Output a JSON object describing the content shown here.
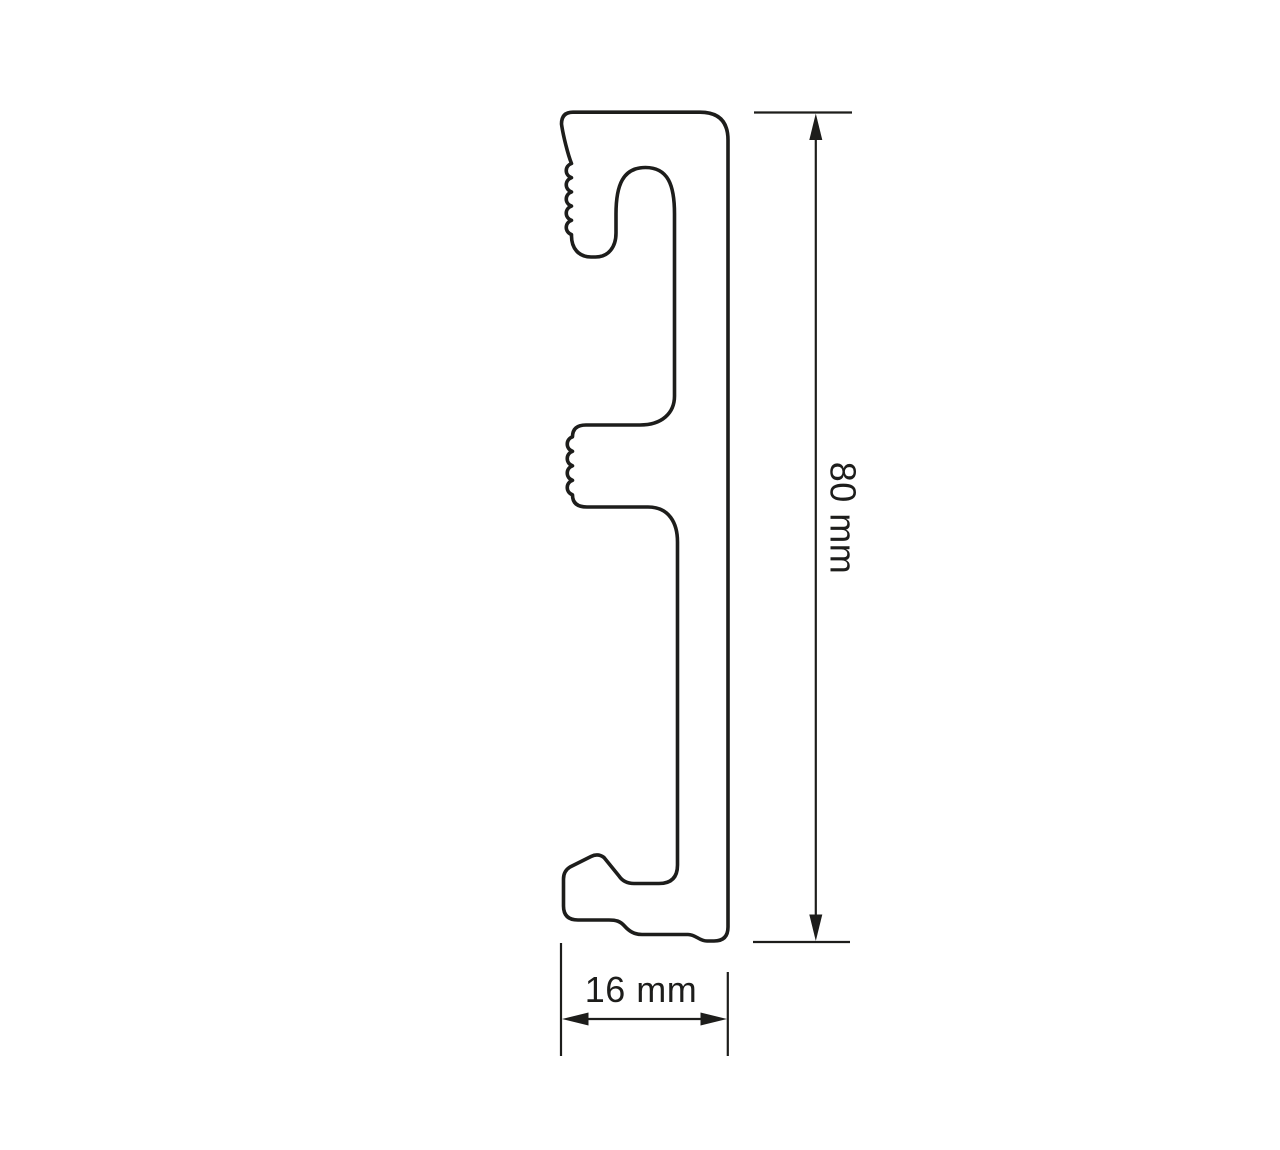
{
  "page": {
    "background_color": "#ffffff",
    "line_color": "#1d1d1b"
  },
  "drawing": {
    "subject": "skirting-board-profile-cross-section",
    "height_dimension": {
      "label": "80 mm"
    },
    "width_dimension": {
      "label": "16 mm"
    }
  }
}
